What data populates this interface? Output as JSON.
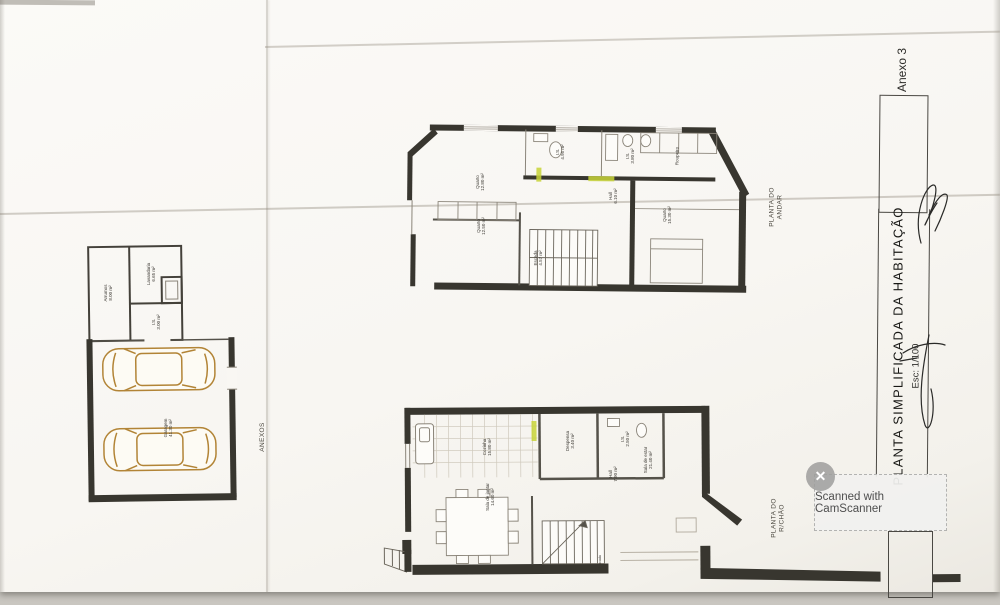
{
  "document": {
    "annex_tab": "Anexo 3",
    "title": "PLANTA SIMPLIFICADA DA HABITAÇÃO",
    "scale": "Esc: 1/100"
  },
  "watermark": {
    "text": "Scanned with CamScanner",
    "close_icon": "✕"
  },
  "plans": {
    "annex": {
      "title": "ANEXOS",
      "rooms": [
        {
          "text": "Arrumos\n8.00 m²"
        },
        {
          "text": "Lavandaria\n6.65 m²"
        },
        {
          "text": "I.S.\n3.00 m²"
        },
        {
          "text": "Garagem\n41.30 m²"
        }
      ]
    },
    "upper": {
      "title": "PLANTA DO\nANDAR",
      "rooms": [
        {
          "text": "Quarto\n12.80 m²"
        },
        {
          "text": "I.S.\n4.95 m²"
        },
        {
          "text": "I.S.\n3.80 m²"
        },
        {
          "text": "Roupeiro"
        },
        {
          "text": "Hall\n6.10 m²"
        },
        {
          "text": "Escada\n4.57 m²"
        },
        {
          "text": "Quarto\n12.50 m²"
        },
        {
          "text": "Quarto\n15.30 m²"
        }
      ]
    },
    "ground": {
      "title": "PLANTA DO\nR/CHÃO",
      "rooms": [
        {
          "text": "Cozinha\n15.80 m²"
        },
        {
          "text": "Despensa\n3.40 m²"
        },
        {
          "text": "I.S.\n2.50 m²"
        },
        {
          "text": "Hall\n7.90 m²"
        },
        {
          "text": "Sala de estar\n21.40 m²"
        },
        {
          "text": "Sala de jantar\n14.60 m²"
        },
        {
          "text": "Escada"
        }
      ]
    }
  },
  "colors": {
    "wall": "#38362f",
    "car": "#b28436",
    "highlight": "#c8d438",
    "paper": "#f9f7f3"
  }
}
